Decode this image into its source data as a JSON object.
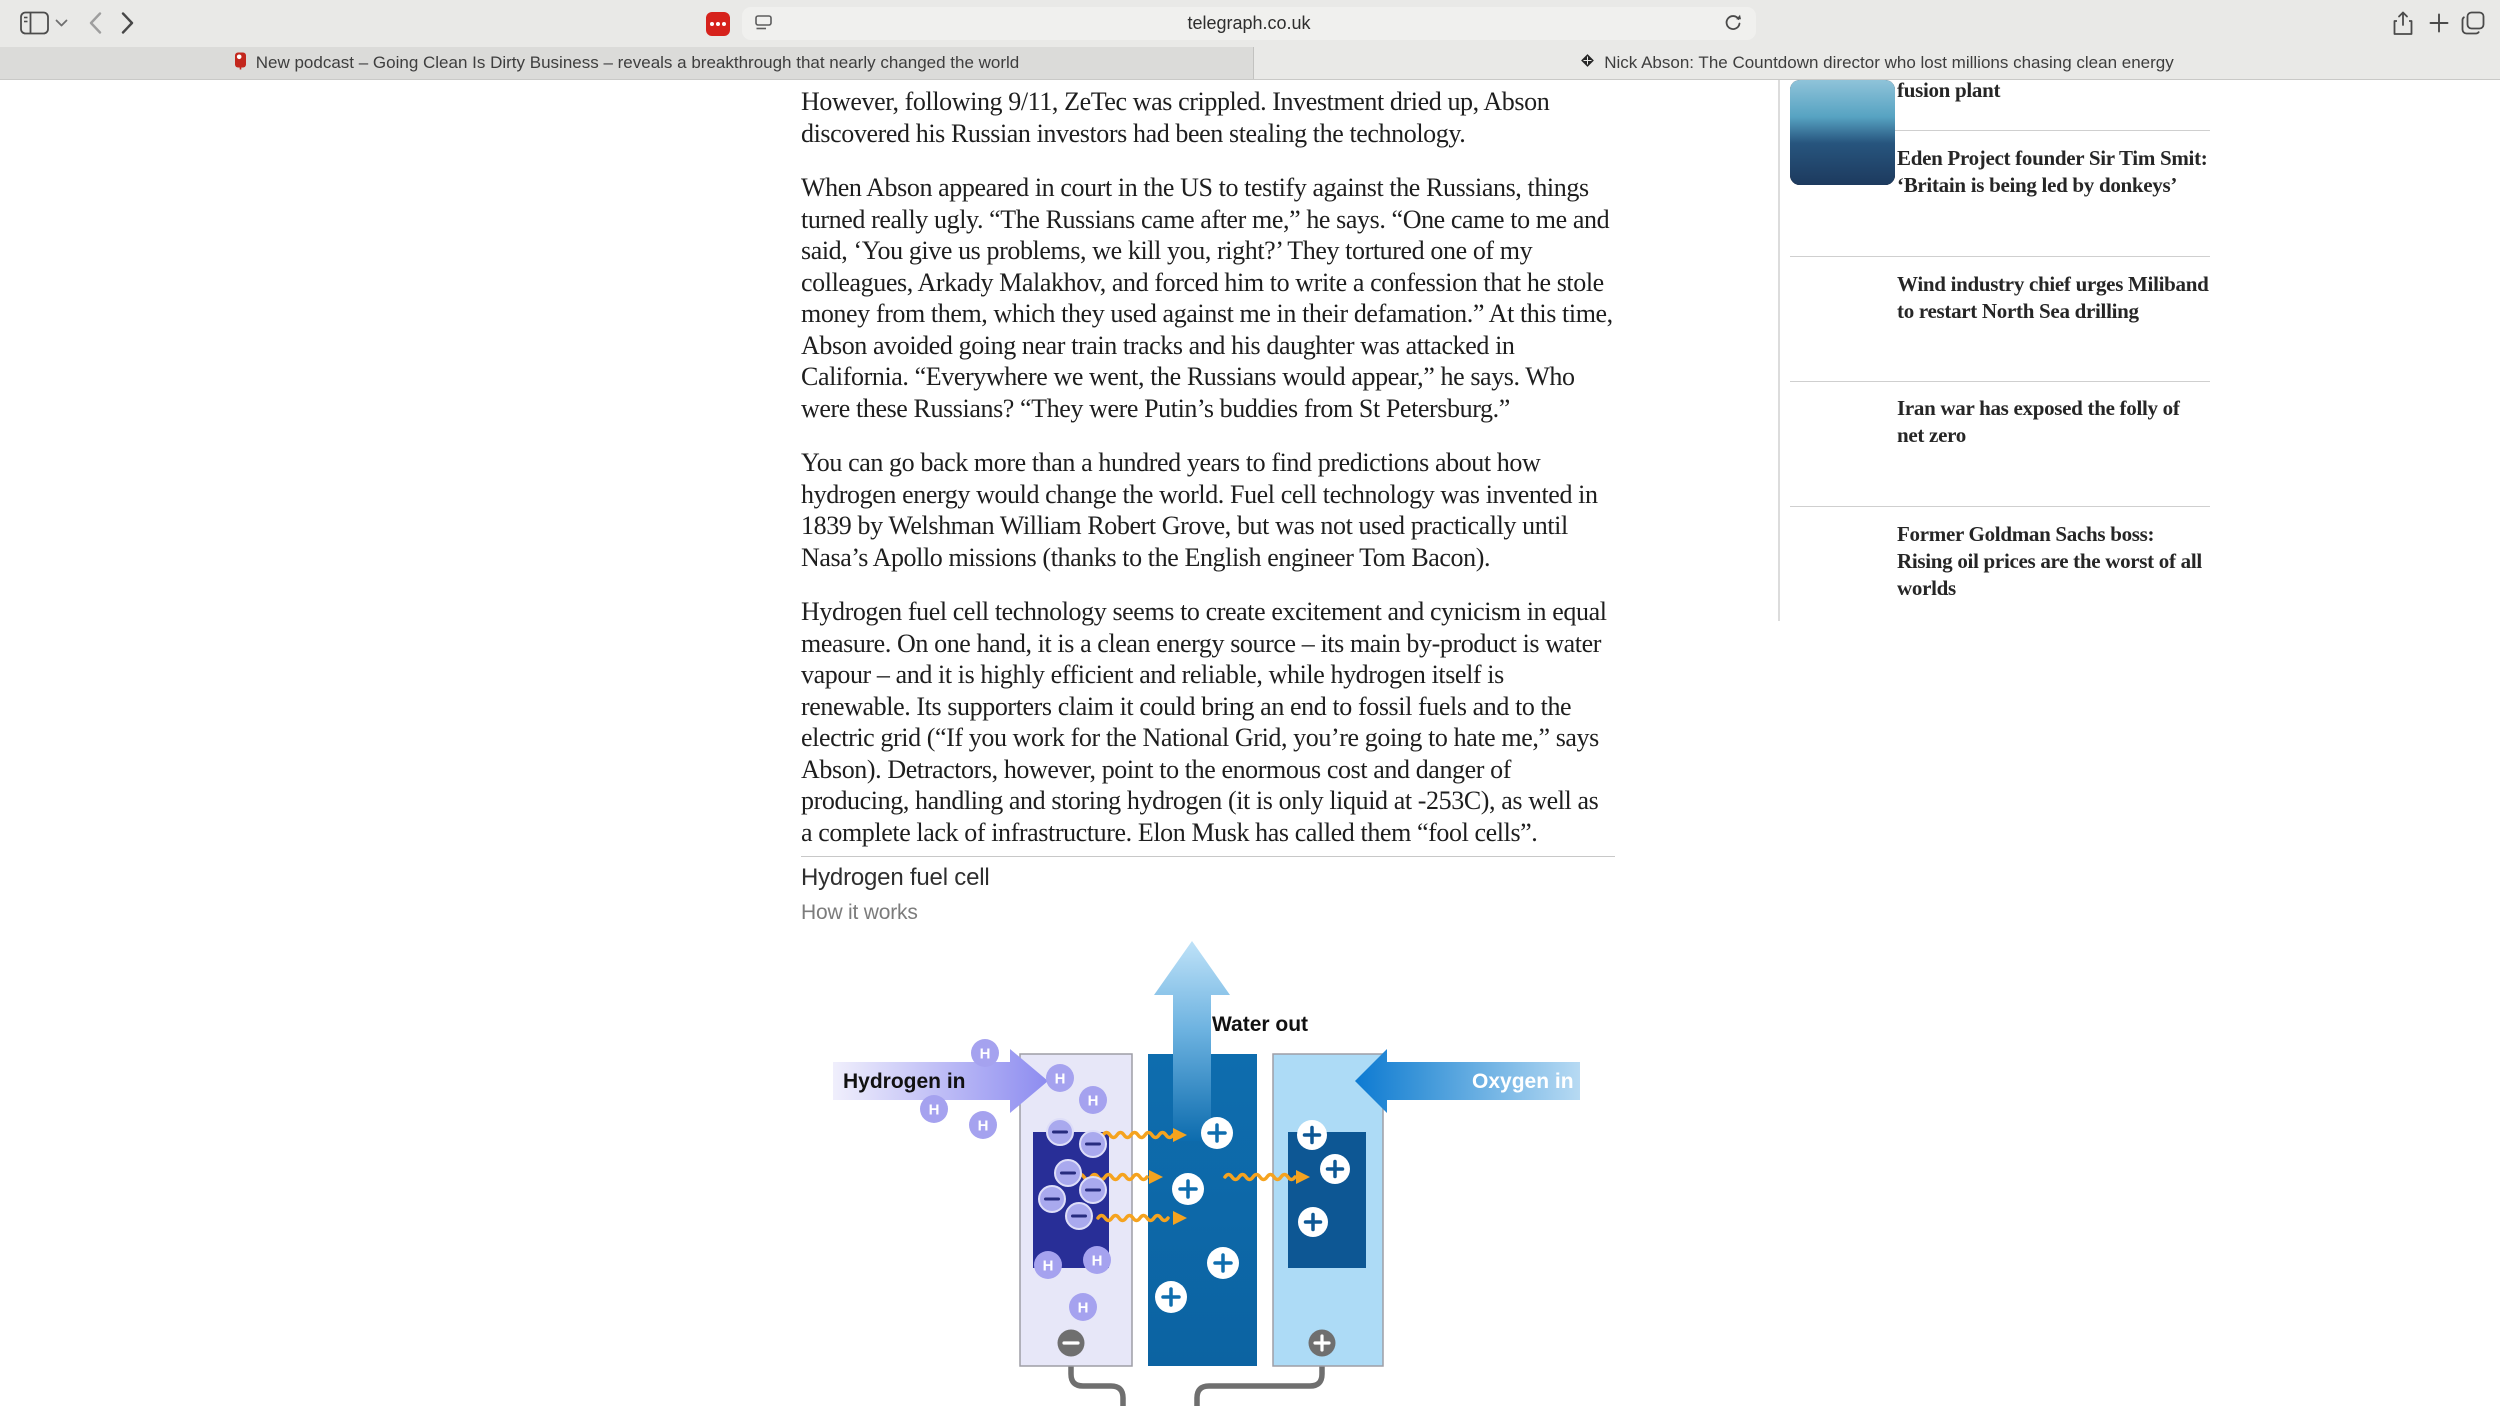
{
  "browser": {
    "url": "telegraph.co.uk",
    "icons": [
      "sidebar",
      "chevron-down",
      "back",
      "forward",
      "extension-dots",
      "page-settings",
      "reload",
      "share",
      "new-tab",
      "tab-overview",
      "tab-pin",
      "telegraph-favicon"
    ],
    "tabs": [
      {
        "title": "New podcast – Going Clean Is Dirty Business – reveals a breakthrough that nearly changed the world"
      },
      {
        "title": "Nick Abson: The Countdown director who lost millions chasing clean energy"
      }
    ]
  },
  "article": {
    "paragraphs": [
      "However, following 9/11, ZeTec was crippled. Investment dried up, Abson discovered his Russian investors had been stealing the technology.",
      "When Abson appeared in court in the US to testify against the Russians, things turned really ugly. “The Russians came after me,” he says. “One came to me and said, ‘You give us problems, we kill you, right?’ They tortured one of my colleagues, Arkady Malakhov, and forced him to write a confession that he stole money from them, which they used against me in their defamation.” At this time, Abson avoided going near train tracks and his daughter was attacked in California. “Everywhere we went, the Russians would appear,” he says. Who were these Russians? “They were Putin’s buddies from St Petersburg.”",
      "You can go back more than a hundred years to find predictions about how hydrogen energy would change the world. Fuel cell technology was invented in 1839 by Welshman William Robert Grove, but was not used practically until Nasa’s Apollo missions (thanks to the English engineer Tom Bacon).",
      "Hydrogen fuel cell technology seems to create excitement and cynicism in equal measure. On one hand, it is a clean energy source – its main by-product is water vapour – and it is highly efficient and reliable, while hydrogen itself is renewable. Its supporters claim it could bring an end to fossil fuels and to the electric grid (“If you work for the National Grid, you’re going to hate me,” says Abson). Detractors, however, point to the enormous cost and danger of producing, handling and storing hydrogen (it is only liquid at -253C), as well as a complete lack of infrastructure. Elon Musk has called them “fool cells”."
    ],
    "section_title": "Hydrogen fuel cell",
    "section_subtitle": "How it works"
  },
  "diagram": {
    "labels": {
      "water_out": "Water out",
      "hydrogen_in": "Hydrogen in",
      "oxygen_in": "Oxygen in"
    },
    "h_label": "H",
    "colors": {
      "water_light": "#bfe2f8",
      "water_deep": "#0d6cae",
      "hydrogen_light": "#f0effc",
      "hydrogen_deep": "#8d8cf0",
      "oxygen_deep": "#0d7ad2",
      "oxygen_light": "#b7daf3",
      "membrane": "#0e6dae",
      "anode_panel": "#e7e7f8",
      "cathode_panel": "#addbf6",
      "anode_box": "#282e97",
      "cathode_box": "#0d5794",
      "h_particle": "#a5a2ef",
      "electron": "#a9a9ee",
      "electron_glyph": "#272c7e",
      "squiggle": "#f5a31f",
      "wire": "#6f6f6f",
      "panel_border": "#9e9ea6"
    },
    "particles": {
      "hydrogen": [
        [
          165,
          117
        ],
        [
          240,
          142
        ],
        [
          273,
          164
        ],
        [
          114,
          173
        ],
        [
          163,
          189
        ],
        [
          228,
          329
        ],
        [
          277,
          324
        ],
        [
          263,
          371
        ]
      ],
      "electrons": [
        [
          240,
          196
        ],
        [
          273,
          208
        ],
        [
          248,
          237
        ],
        [
          232,
          263
        ],
        [
          273,
          254
        ],
        [
          259,
          280
        ]
      ],
      "protons_center": [
        [
          397,
          197
        ],
        [
          368,
          253
        ],
        [
          403,
          327
        ],
        [
          351,
          361
        ]
      ],
      "protons_right": [
        [
          492,
          199
        ],
        [
          515,
          233
        ],
        [
          493,
          286
        ]
      ]
    },
    "squiggles": [
      [
        283,
        199,
        367
      ],
      [
        257,
        241,
        343
      ],
      [
        278,
        282,
        367
      ],
      [
        405,
        241,
        490
      ]
    ]
  },
  "sidebar": {
    "items": [
      {
        "headline": "fusion plant",
        "thumb": "background:linear-gradient(120deg,#9b5f86,#c7bfca 30%,#27407a 60%,#16294e)"
      },
      {
        "headline": "Eden Project founder Sir Tim Smit: ‘Britain is being led by donkeys’",
        "thumb": "background:linear-gradient(180deg,#8a9688,#cfd3cd 40%,#6e5a43 75%,#4e3c2b)"
      },
      {
        "headline": "Wind industry chief urges Miliband to restart North Sea drilling",
        "thumb": "background:linear-gradient(180deg,#2b3050,#6e4a6e 45%,#e0833f 70%,#d2622e 85%,#31425c)"
      },
      {
        "headline": "Iran war has exposed the folly of net zero",
        "thumb": "background:radial-gradient(circle at 62% 28%,#c8452c 0 11%,rgba(0,0,0,0) 12%),linear-gradient(160deg,#9a9aa0,#6a6a72 40%,#2e2e34 75%,#17171c)"
      },
      {
        "headline": "Former Goldman Sachs boss: Rising oil prices are the worst of all worlds",
        "thumb": "background:linear-gradient(180deg,#8fc3d9,#57a3c2 35%,#27557e 60%,#1d3a5e)"
      }
    ]
  }
}
